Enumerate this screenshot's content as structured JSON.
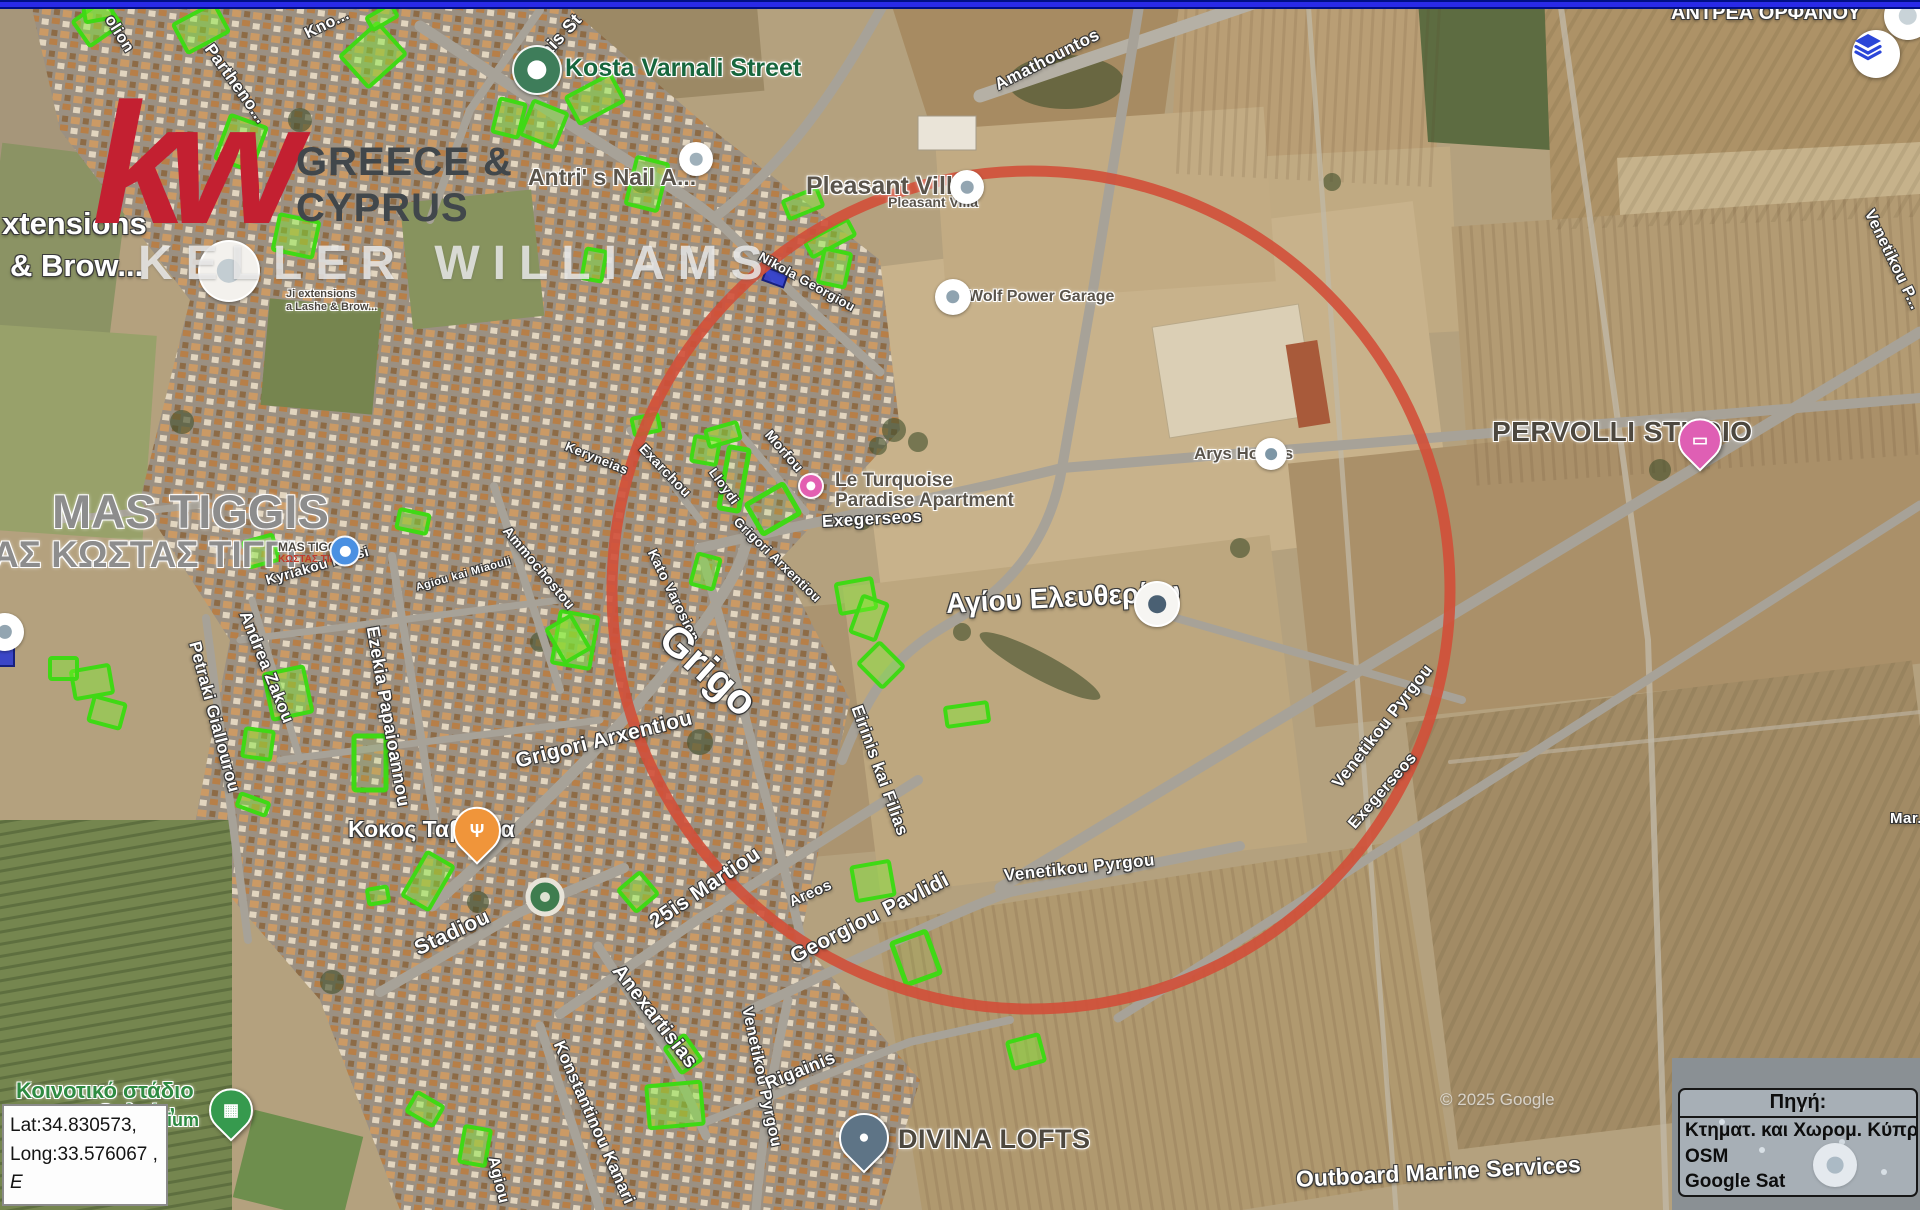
{
  "top_bar": {
    "color": "#2a2ae8"
  },
  "watermark": {
    "kw": "kw",
    "line1": "GREECE &",
    "line2": "CYPRUS",
    "line3": "KELLER WILLIAMS",
    "red": "#c32031"
  },
  "controls": {
    "layers_button": {
      "icon": "layers-icon",
      "color": "#2b46d8"
    }
  },
  "coords_box": {
    "line1": "Lat:34.830573,",
    "line2": "Long:33.576067 ,",
    "line3": "E"
  },
  "source_box": {
    "title": "Πηγή:",
    "lines": [
      "Κτηματ. και Χωρομ. Κύπρου",
      "OSM",
      "Google Sat"
    ]
  },
  "overlay": {
    "circle": {
      "cx": 1031,
      "cy": 590,
      "r": 419,
      "color": "#d14f39",
      "stroke": 11
    },
    "plot_fill": "rgba(125,240,45,0.42)",
    "plot_stroke": "#3fd915",
    "blue_plot_fill": "rgba(38,54,212,0.85)",
    "plots": [
      [
        78,
        8,
        38,
        30,
        -35,
        1
      ],
      [
        178,
        12,
        46,
        32,
        -28,
        1
      ],
      [
        348,
        34,
        50,
        42,
        -42,
        1
      ],
      [
        368,
        10,
        28,
        14,
        -30,
        1
      ],
      [
        222,
        120,
        38,
        46,
        20,
        1
      ],
      [
        276,
        218,
        40,
        36,
        12,
        1
      ],
      [
        570,
        84,
        50,
        30,
        -28,
        1
      ],
      [
        496,
        101,
        26,
        34,
        14,
        1
      ],
      [
        526,
        106,
        36,
        36,
        22,
        1
      ],
      [
        806,
        230,
        48,
        17,
        -28,
        1
      ],
      [
        821,
        251,
        27,
        34,
        12,
        1
      ],
      [
        631,
        160,
        32,
        48,
        14,
        1
      ],
      [
        785,
        194,
        36,
        19,
        -22,
        1
      ],
      [
        633,
        416,
        26,
        17,
        -12,
        1
      ],
      [
        693,
        438,
        25,
        25,
        10,
        1
      ],
      [
        707,
        426,
        32,
        17,
        -16,
        1
      ],
      [
        724,
        448,
        20,
        62,
        10,
        0
      ],
      [
        752,
        492,
        42,
        34,
        -30,
        0
      ],
      [
        838,
        581,
        36,
        30,
        -10,
        1
      ],
      [
        856,
        599,
        26,
        38,
        20,
        1
      ],
      [
        556,
        614,
        38,
        52,
        10,
        1
      ],
      [
        864,
        650,
        34,
        30,
        45,
        1
      ],
      [
        246,
        538,
        30,
        26,
        -15,
        1
      ],
      [
        398,
        512,
        30,
        19,
        12,
        1
      ],
      [
        268,
        670,
        40,
        46,
        -12,
        1
      ],
      [
        244,
        730,
        28,
        28,
        8,
        1
      ],
      [
        354,
        736,
        32,
        54,
        0,
        0
      ],
      [
        554,
        620,
        28,
        38,
        -30,
        1
      ],
      [
        238,
        798,
        30,
        13,
        20,
        1
      ],
      [
        413,
        856,
        30,
        50,
        30,
        1
      ],
      [
        624,
        878,
        28,
        28,
        50,
        1
      ],
      [
        854,
        864,
        38,
        34,
        -10,
        1
      ],
      [
        668,
        1042,
        30,
        24,
        55,
        1
      ],
      [
        648,
        1084,
        54,
        42,
        -5,
        1
      ],
      [
        898,
        936,
        36,
        44,
        -20,
        0
      ],
      [
        410,
        1098,
        30,
        22,
        30,
        1
      ],
      [
        368,
        888,
        20,
        15,
        -10,
        1
      ],
      [
        73,
        668,
        38,
        28,
        -10,
        1
      ],
      [
        91,
        700,
        32,
        25,
        15,
        1
      ],
      [
        50,
        658,
        27,
        21,
        0,
        1
      ],
      [
        1010,
        1038,
        32,
        27,
        -15,
        1
      ],
      [
        462,
        1128,
        26,
        36,
        10,
        1
      ],
      [
        694,
        556,
        23,
        31,
        15,
        1
      ],
      [
        946,
        705,
        42,
        19,
        -8,
        1
      ],
      [
        84,
        0,
        28,
        20,
        -10,
        1
      ],
      [
        584,
        250,
        20,
        30,
        10,
        1
      ]
    ],
    "blue_plots": [
      [
        764,
        271,
        22,
        13,
        20
      ],
      [
        -4,
        648,
        18,
        18,
        0
      ]
    ]
  },
  "street_labels": [
    {
      "t": "olion",
      "x": 108,
      "y": 8,
      "r": 58,
      "s": 16
    },
    {
      "t": "Partheno...",
      "x": 208,
      "y": 36,
      "r": 54,
      "s": 17
    },
    {
      "t": "Kno...",
      "x": 306,
      "y": 26,
      "r": -26,
      "s": 16
    },
    {
      "t": "pais St",
      "x": 536,
      "y": 52,
      "r": -47,
      "s": 18
    },
    {
      "t": "Amathountos",
      "x": 996,
      "y": 76,
      "r": -27,
      "s": 17
    },
    {
      "t": "Venetikou P...",
      "x": 1868,
      "y": 202,
      "r": 64,
      "s": 16
    },
    {
      "t": "Nikola Georgiou",
      "x": 760,
      "y": 248,
      "r": 29,
      "s": 13
    },
    {
      "t": "Morfou",
      "x": 768,
      "y": 424,
      "r": 49,
      "s": 14
    },
    {
      "t": "Exarchou",
      "x": 642,
      "y": 438,
      "r": 46,
      "s": 14
    },
    {
      "t": "Keryneias",
      "x": 566,
      "y": 438,
      "r": 22,
      "s": 13
    },
    {
      "t": "Lloydi",
      "x": 712,
      "y": 462,
      "r": 54,
      "s": 13
    },
    {
      "t": "Kato Varosion",
      "x": 652,
      "y": 542,
      "r": 64,
      "s": 14
    },
    {
      "t": "Grigori Arxentiou",
      "x": 736,
      "y": 512,
      "r": 44,
      "s": 13
    },
    {
      "t": "Exegerseos",
      "x": 822,
      "y": 512,
      "r": -3,
      "s": 17
    },
    {
      "t": "Eirinis kai Filias",
      "x": 856,
      "y": 696,
      "r": 70,
      "s": 17
    },
    {
      "t": "Grigo",
      "x": 666,
      "y": 608,
      "r": 42,
      "s": 42
    },
    {
      "t": "Grigori Arxentiou",
      "x": 516,
      "y": 750,
      "r": -14,
      "s": 21
    },
    {
      "t": "Ammochostou",
      "x": 506,
      "y": 520,
      "r": 50,
      "s": 14
    },
    {
      "t": "Agiou kai Miaouli",
      "x": 416,
      "y": 582,
      "r": -16,
      "s": 11
    },
    {
      "t": "Kyriakou Matsi",
      "x": 266,
      "y": 572,
      "r": -16,
      "s": 14
    },
    {
      "t": "Ezekia Papaioannou",
      "x": 372,
      "y": 616,
      "r": 80,
      "s": 18
    },
    {
      "t": "Andrea Zakou",
      "x": 244,
      "y": 602,
      "r": 68,
      "s": 17
    },
    {
      "t": "Petraki Giallourou",
      "x": 194,
      "y": 632,
      "r": 75,
      "s": 17
    },
    {
      "t": "Stadiou",
      "x": 416,
      "y": 938,
      "r": -25,
      "s": 21
    },
    {
      "t": "25is Martiou",
      "x": 652,
      "y": 912,
      "r": -34,
      "s": 21
    },
    {
      "t": "Areos",
      "x": 790,
      "y": 894,
      "r": -24,
      "s": 15
    },
    {
      "t": "Georgiou Pavlidi",
      "x": 792,
      "y": 946,
      "r": -27,
      "s": 21
    },
    {
      "t": "Anexartisias",
      "x": 616,
      "y": 956,
      "r": 52,
      "s": 20
    },
    {
      "t": "Konstantinou Kanari",
      "x": 558,
      "y": 1032,
      "r": 66,
      "s": 17
    },
    {
      "t": "Venetikou Pyrgou",
      "x": 746,
      "y": 998,
      "r": 78,
      "s": 16
    },
    {
      "t": "Rigainis",
      "x": 766,
      "y": 1074,
      "r": -22,
      "s": 18
    },
    {
      "t": "Venetikou Pyrgou",
      "x": 1004,
      "y": 866,
      "r": -6,
      "s": 17
    },
    {
      "t": "Venetikou Pyrgou",
      "x": 1336,
      "y": 776,
      "r": -52,
      "s": 17
    },
    {
      "t": "Exegerseos",
      "x": 1352,
      "y": 818,
      "r": -49,
      "s": 16
    },
    {
      "t": "Agiou",
      "x": 492,
      "y": 1148,
      "r": 76,
      "s": 16
    },
    {
      "t": "Mar...",
      "x": 1890,
      "y": 810,
      "r": 0,
      "s": 15
    }
  ],
  "poi_labels": [
    {
      "t": "Kosta Varnali Street",
      "x": 565,
      "y": 54,
      "s": 25,
      "c": "green"
    },
    {
      "t": "Antri' s Nail A...",
      "x": 528,
      "y": 164,
      "s": 23,
      "c": "dark"
    },
    {
      "t": "xtensions",
      "x": 2,
      "y": 206,
      "s": 31,
      "c": "white"
    },
    {
      "t": "& Brow...",
      "x": 10,
      "y": 248,
      "s": 31,
      "c": "white"
    },
    {
      "t": "Ji extensions",
      "x": 286,
      "y": 288,
      "s": 11,
      "c": "tiny"
    },
    {
      "t": "a Lashe & Brow...",
      "x": 286,
      "y": 301,
      "s": 11,
      "c": "tiny"
    },
    {
      "t": "Pleasant Villa",
      "x": 806,
      "y": 172,
      "s": 25,
      "c": "dark"
    },
    {
      "t": "Pleasant Villa",
      "x": 888,
      "y": 194,
      "s": 14,
      "c": "dark"
    },
    {
      "t": "Wolf Power Garage",
      "x": 968,
      "y": 288,
      "s": 16,
      "c": "dark"
    },
    {
      "t": "Le Turquoise",
      "x": 835,
      "y": 470,
      "s": 19,
      "c": "dark"
    },
    {
      "t": "Paradise Apartment",
      "x": 835,
      "y": 490,
      "s": 19,
      "c": "dark"
    },
    {
      "t": "Arys Homes",
      "x": 1194,
      "y": 444,
      "s": 17,
      "c": "dark"
    },
    {
      "t": "PERVOLLI STUDIO",
      "x": 1492,
      "y": 416,
      "s": 28,
      "c": "darkbold"
    },
    {
      "t": "Αγίου Ελευθερίου",
      "x": 946,
      "y": 588,
      "s": 28,
      "c": "white",
      "r": -3
    },
    {
      "t": "ΑΝΤΡΕΑ ΟΡΦΑΝΟΥ",
      "x": 1671,
      "y": 2,
      "s": 20,
      "c": "white"
    },
    {
      "t": "MAS TIGGIS",
      "x": 52,
      "y": 484,
      "s": 47,
      "c": "biggray"
    },
    {
      "t": "ΑΣ ΚΩΣΤΑΣ ΤΙΓΓΙ",
      "x": -8,
      "y": 534,
      "s": 37,
      "c": "biggray"
    },
    {
      "t": "MAS TIGGIS",
      "x": 278,
      "y": 540,
      "s": 12,
      "c": "tiny"
    },
    {
      "t": "ΚΩΣΤΑΣ ΤΙΓΓΙΣ",
      "x": 278,
      "y": 554,
      "s": 10,
      "c": "tinyred"
    },
    {
      "t": "Κοκος Ταβέρνα",
      "x": 348,
      "y": 816,
      "s": 23,
      "c": "white"
    },
    {
      "t": "Κοινοτικό στάδιο",
      "x": 16,
      "y": 1078,
      "s": 22,
      "c": "stadium"
    },
    {
      "t": "περβολιών",
      "x": 58,
      "y": 1100,
      "s": 22,
      "c": "stadium"
    },
    {
      "t": "Stadium",
      "x": 128,
      "y": 1110,
      "s": 18,
      "c": "stadium"
    },
    {
      "t": "DIVINA LOFTS",
      "x": 898,
      "y": 1124,
      "s": 27,
      "c": "darkbold"
    },
    {
      "t": "Outboard Marine Services",
      "x": 1296,
      "y": 1166,
      "s": 23,
      "c": "white",
      "r": -3
    },
    {
      "t": "© 2025 Google",
      "x": 1440,
      "y": 1090,
      "s": 17,
      "c": "credit"
    }
  ],
  "markers": [
    {
      "name": "kosta-varnali-street-marker",
      "type": "dot",
      "x": 537,
      "y": 70,
      "d": 46,
      "bg": "#3e7d5a",
      "dot": "#ffffff"
    },
    {
      "name": "antris-nail-marker",
      "type": "dot",
      "x": 696,
      "y": 159,
      "d": 30,
      "bg": "#ffffff",
      "dot": "#9fb0ba"
    },
    {
      "name": "lash-brow-extensions-marker",
      "type": "dot",
      "x": 229,
      "y": 271,
      "d": 58,
      "bg": "#f3f1ed",
      "dot": "#c3cdd2"
    },
    {
      "name": "pleasant-villa-marker",
      "type": "dot",
      "x": 967,
      "y": 187,
      "d": 30,
      "bg": "#ffffff",
      "dot": "#93a5b1"
    },
    {
      "name": "wolf-power-garage-marker",
      "type": "dot",
      "x": 953,
      "y": 297,
      "d": 32,
      "bg": "#ffffff",
      "dot": "#8fa3b0"
    },
    {
      "name": "le-turquoise-marker",
      "type": "dot",
      "x": 811,
      "y": 486,
      "d": 22,
      "bg": "#e35fb1",
      "dot": "#ffffff"
    },
    {
      "name": "agiou-eleftheriou-church-marker",
      "type": "dot",
      "x": 1157,
      "y": 604,
      "d": 42,
      "bg": "#f6f5f2",
      "dot": "#4a6073"
    },
    {
      "name": "arys-homes-marker",
      "type": "dot",
      "x": 1271,
      "y": 454,
      "d": 28,
      "bg": "#ffffff",
      "dot": "#7d96a6"
    },
    {
      "name": "pervolli-studio-marker",
      "type": "pin",
      "x": 1700,
      "y": 458,
      "d": 40,
      "bg": "#df5fb4",
      "icon": "▭",
      "iconName": "bed-icon"
    },
    {
      "name": "mas-tiggis-marker",
      "type": "dot",
      "x": 345,
      "y": 551,
      "d": 27,
      "bg": "#4a90e2",
      "dot": "#ffffff"
    },
    {
      "name": "kokos-taverna-marker",
      "type": "pin",
      "x": 477,
      "y": 850,
      "d": 44,
      "bg": "#f0953a",
      "icon": "Ψ",
      "iconName": "utensils-icon"
    },
    {
      "name": "community-stadium-marker",
      "type": "pin",
      "x": 231,
      "y": 1128,
      "d": 40,
      "bg": "#369a4e",
      "icon": "▦",
      "iconName": "stadium-icon"
    },
    {
      "name": "divina-lofts-marker",
      "type": "pin",
      "x": 864,
      "y": 1158,
      "d": 46,
      "bg": "#5e7486",
      "icon": "●",
      "iconName": "circle-icon"
    },
    {
      "name": "outboard-marine-marker",
      "type": "dot",
      "x": 1835,
      "y": 1165,
      "d": 40,
      "bg": "#ffffff",
      "dot": "#93a5b1"
    },
    {
      "name": "corner-poi-marker",
      "type": "dot",
      "x": 1908,
      "y": 16,
      "d": 44,
      "bg": "#ffffff",
      "dot": "#c9d3d8"
    },
    {
      "name": "left-edge-poi-marker",
      "type": "dot",
      "x": 5,
      "y": 632,
      "d": 34,
      "bg": "#ffffff",
      "dot": "#93a5b1"
    }
  ]
}
